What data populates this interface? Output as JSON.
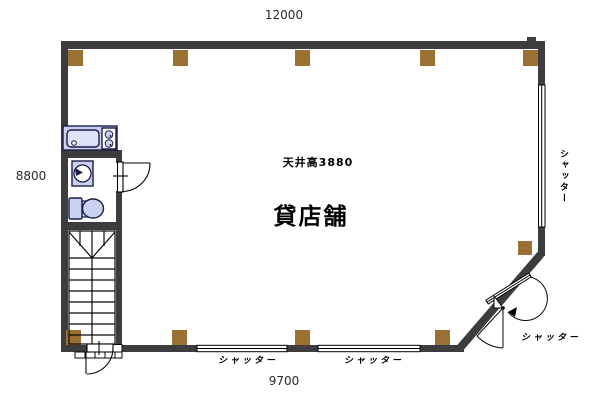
{
  "plan": {
    "room_label": "貸店舗",
    "ceiling_note": "天井高3880"
  },
  "dimensions": {
    "top": "12000",
    "left": "8800",
    "bottom": "9700"
  },
  "shutters": {
    "right": "シャッター",
    "bottom_left": "シャッター",
    "bottom_right": "シャッター",
    "corner": "シャッター"
  },
  "colors": {
    "wall": "#3d3d3f",
    "column": "#9c7033",
    "fixture_fill": "#c9d2f1",
    "fixture_inner": "#dde3f8",
    "fixture_stroke": "#1c1c46",
    "line": "#000000",
    "background": "#ffffff"
  }
}
